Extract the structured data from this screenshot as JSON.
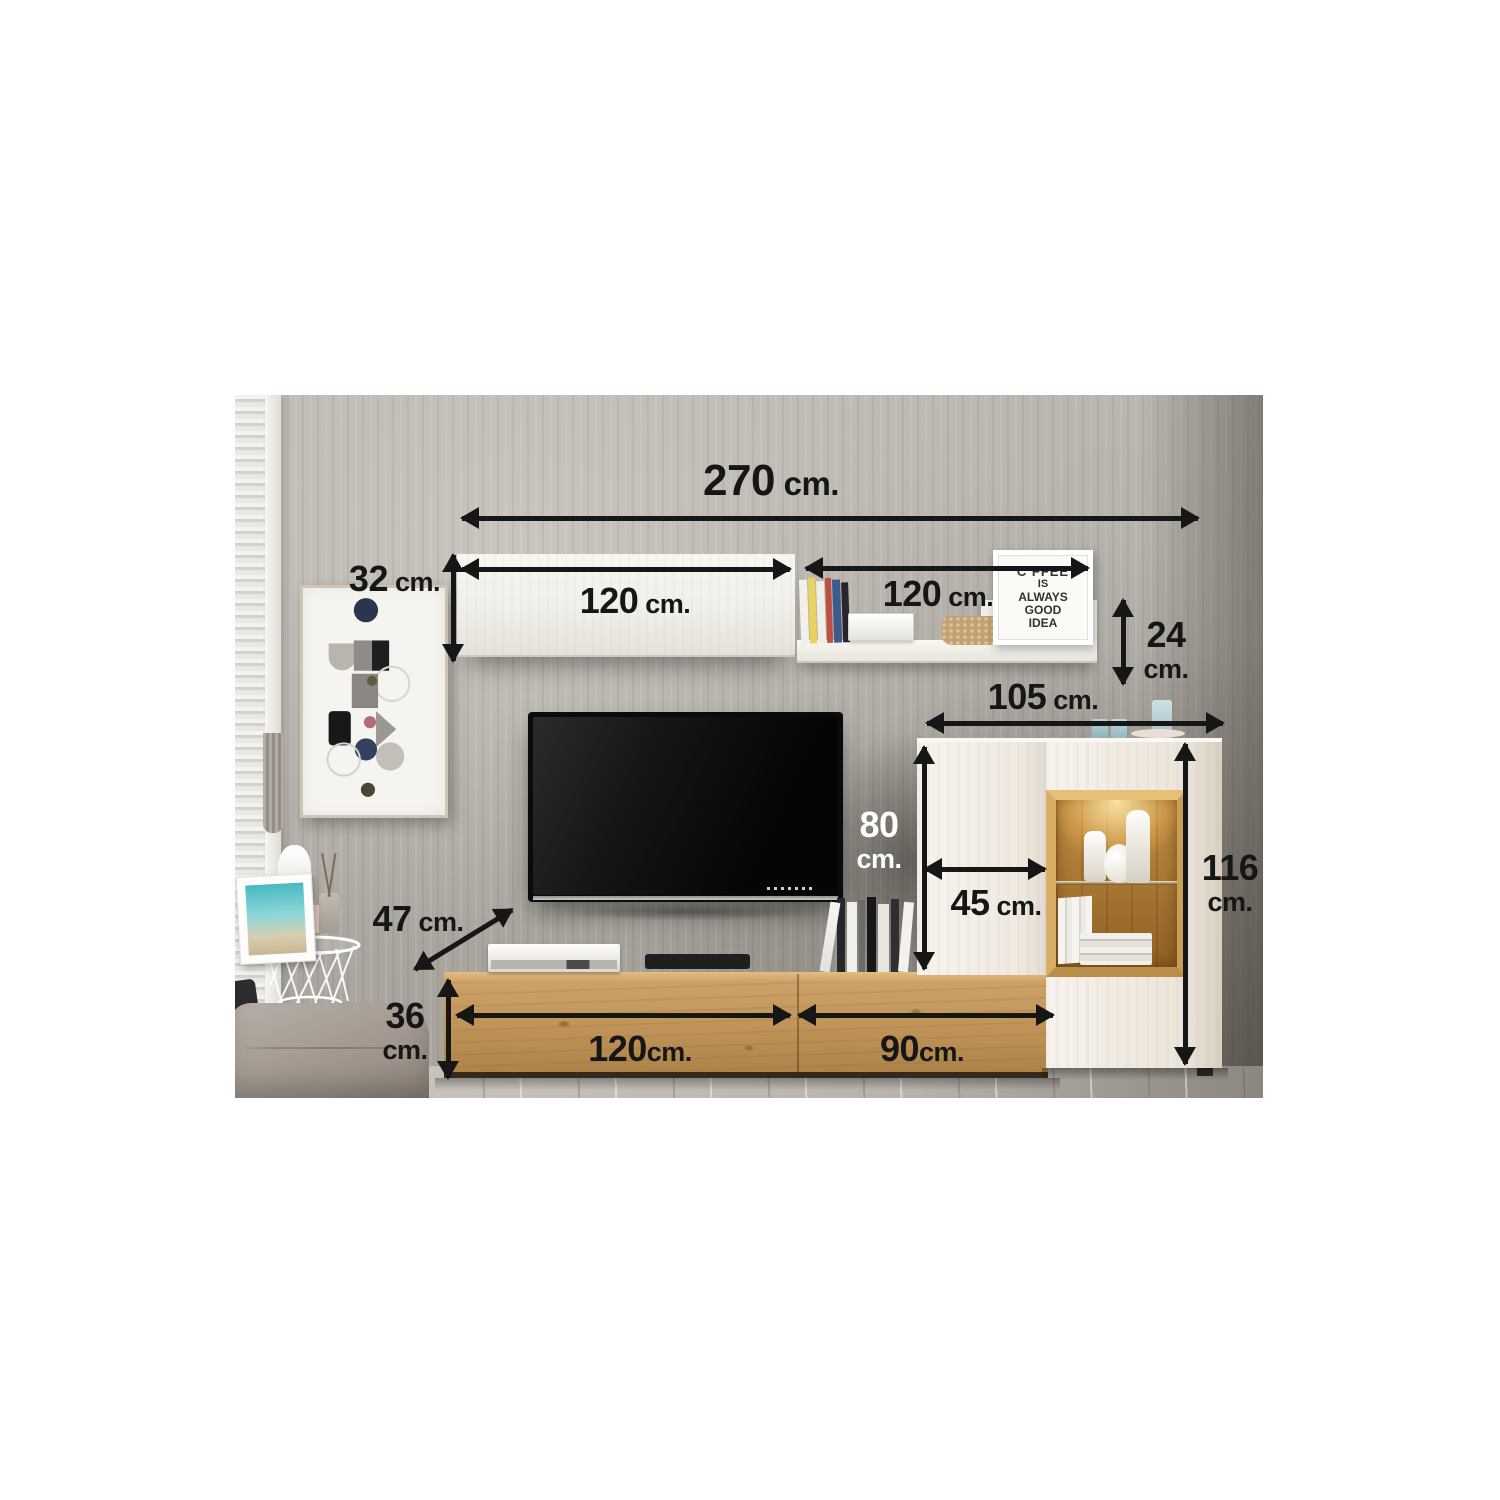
{
  "dims": {
    "total_width": {
      "num": "270",
      "unit": " cm."
    },
    "shelf_depth": {
      "num": "32",
      "unit": " cm."
    },
    "shelf_left_width": {
      "num": "120",
      "unit": " cm."
    },
    "shelf_right_width": {
      "num": "120",
      "unit": " cm."
    },
    "shelf_right_height": {
      "num": "24",
      "unit": "cm."
    },
    "cabinet_width": {
      "num": "105",
      "unit": " cm."
    },
    "cabinet_upper_height": {
      "num": "80",
      "unit": "cm."
    },
    "cabinet_door_width": {
      "num": "45",
      "unit": " cm."
    },
    "cabinet_height": {
      "num": "116",
      "unit": "cm."
    },
    "stand_depth": {
      "num": "47",
      "unit": " cm."
    },
    "stand_height": {
      "num": "36",
      "unit": "cm."
    },
    "stand_left_width": {
      "num": "120",
      "unit": "cm."
    },
    "stand_right_width": {
      "num": "90",
      "unit": "cm."
    }
  },
  "coffee_poster": {
    "lines": [
      "C FFEE",
      "IS",
      "ALWAYS",
      "GOOD",
      "IDEA"
    ]
  },
  "colors": {
    "arrow": "#161616",
    "label_dark": "#161616",
    "label_light": "#ffffff",
    "wood": "#c49a5e",
    "cabinet": "#f4f0e9",
    "wall": "#b5b1ab",
    "floor": "#c8c3bc",
    "tv_screen": "#0b0b0b",
    "display_interior_wood": "#a5742f"
  }
}
